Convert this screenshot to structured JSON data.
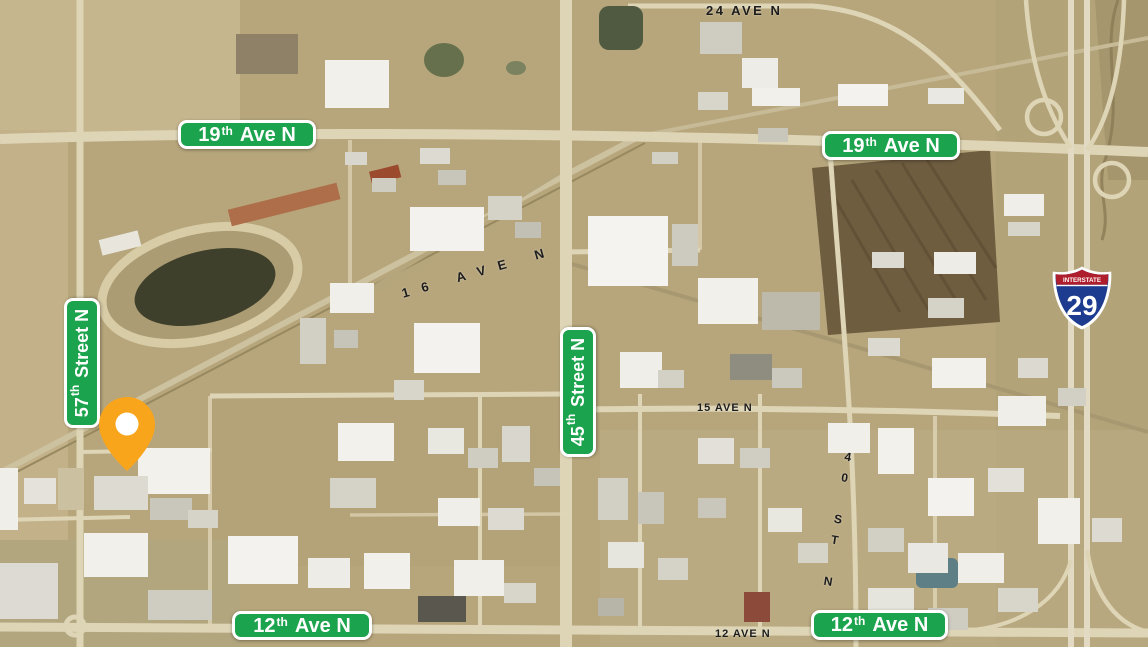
{
  "map": {
    "colors": {
      "badge_green": "#1CA34D",
      "pin_orange": "#F9A51C",
      "shield_red": "#AF1E2D",
      "shield_blue": "#1D3C8F",
      "land_tan": "#B7A67C"
    },
    "street_badges": [
      {
        "number": "19",
        "suffix": "th",
        "name": "Ave N"
      },
      {
        "number": "19",
        "suffix": "th",
        "name": "Ave N"
      },
      {
        "number": "57",
        "suffix": "th",
        "name": "Street N"
      },
      {
        "number": "45",
        "suffix": "th",
        "name": "Street N"
      },
      {
        "number": "12",
        "suffix": "th",
        "name": "Ave N"
      },
      {
        "number": "12",
        "suffix": "th",
        "name": "Ave N"
      }
    ],
    "imagery_labels": {
      "ave24": "24 AVE N",
      "ave16": "16 AVE N",
      "ave15": "15 AVE N",
      "ave12": "12 AVE N",
      "st40": "40 ST N"
    },
    "interstate_shield": {
      "top_label": "INTERSTATE",
      "route_number": "29"
    }
  }
}
